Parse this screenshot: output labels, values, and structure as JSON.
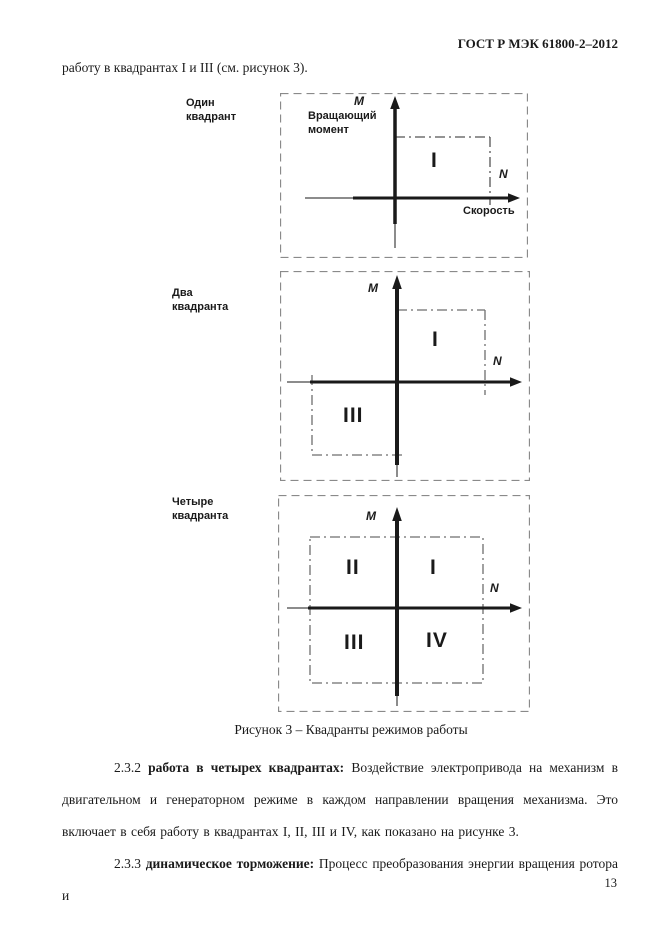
{
  "header": {
    "title": "ГОСТ Р МЭК 61800-2–2012"
  },
  "intro_line": "работу в квадрантах I и III (см. рисунок 3).",
  "figure": {
    "caption": "Рисунок 3 – Квадранты режимов работы",
    "axes": {
      "vertical_symbol": "M",
      "horizontal_symbol": "N",
      "vertical_name": "Вращающий момент",
      "horizontal_name": "Скорость"
    },
    "diagrams": [
      {
        "label": "Один квадрант",
        "quadrants": {
          "q1": "I"
        }
      },
      {
        "label": "Два квадранта",
        "quadrants": {
          "q1": "I",
          "q3": "III"
        }
      },
      {
        "label": "Четыре квадранта",
        "quadrants": {
          "q1": "I",
          "q2": "II",
          "q3": "III",
          "q4": "IV"
        }
      }
    ]
  },
  "paragraphs": [
    {
      "number": "2.3.2",
      "term": "работа в четырех квадрантах:",
      "body": "Воздействие электропривода на механизм в двигательном и генераторном режиме в каждом направлении вращения  механизма. Это включает в себя работу в квадрантах I, II, III и IV, как показано на рисунке 3."
    },
    {
      "number": "2.3.3",
      "term": "динамическое торможение:",
      "body": "Процесс преобразования энергии вращения ротора и"
    }
  ],
  "page_number": "13",
  "colors": {
    "ink": "#1a1a1a",
    "dashed_frame": "#8a8a8a",
    "dashdot_line": "#6e6e6e"
  }
}
